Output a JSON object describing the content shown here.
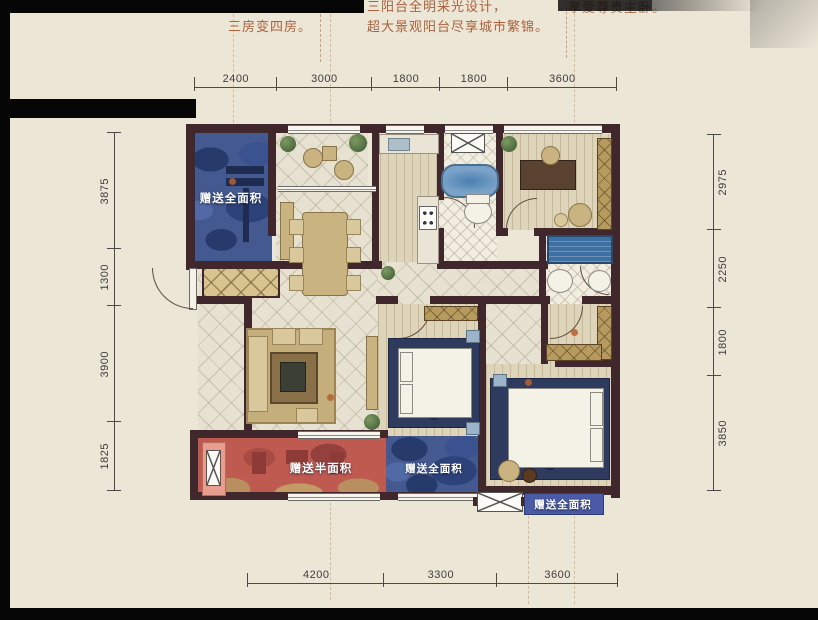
{
  "header": {
    "left_slogan": "三房变四房。",
    "mid_slogan_line1": "三阳台全明采光设计，",
    "mid_slogan_line2": "超大景观阳台尽享城市繁锦。",
    "right_slogan": "孝爱尊贵主卧。"
  },
  "dimensions": {
    "top": [
      "2400",
      "3000",
      "1800",
      "1800",
      "3600"
    ],
    "bottom": [
      "4200",
      "3300",
      "3600"
    ],
    "left": [
      "3875",
      "1300",
      "3900",
      "1825"
    ],
    "right": [
      "2975",
      "2250",
      "1800",
      "3850"
    ]
  },
  "plan_labels": {
    "gift_full_top": "赠送全面积",
    "gift_half": "赠送半面积",
    "gift_full_mid": "赠送全面积",
    "gift_full_bottom": "赠送全面积"
  },
  "colors": {
    "paper": "#ece6d7",
    "wall": "#3f272b",
    "gift_area_blue": "#44598f",
    "gift_area_red": "#bf5a50",
    "gift_tag_blue": "#4b5aa5",
    "slogan_text": "#a9623c",
    "dimension_text": "#3c3c3c"
  }
}
